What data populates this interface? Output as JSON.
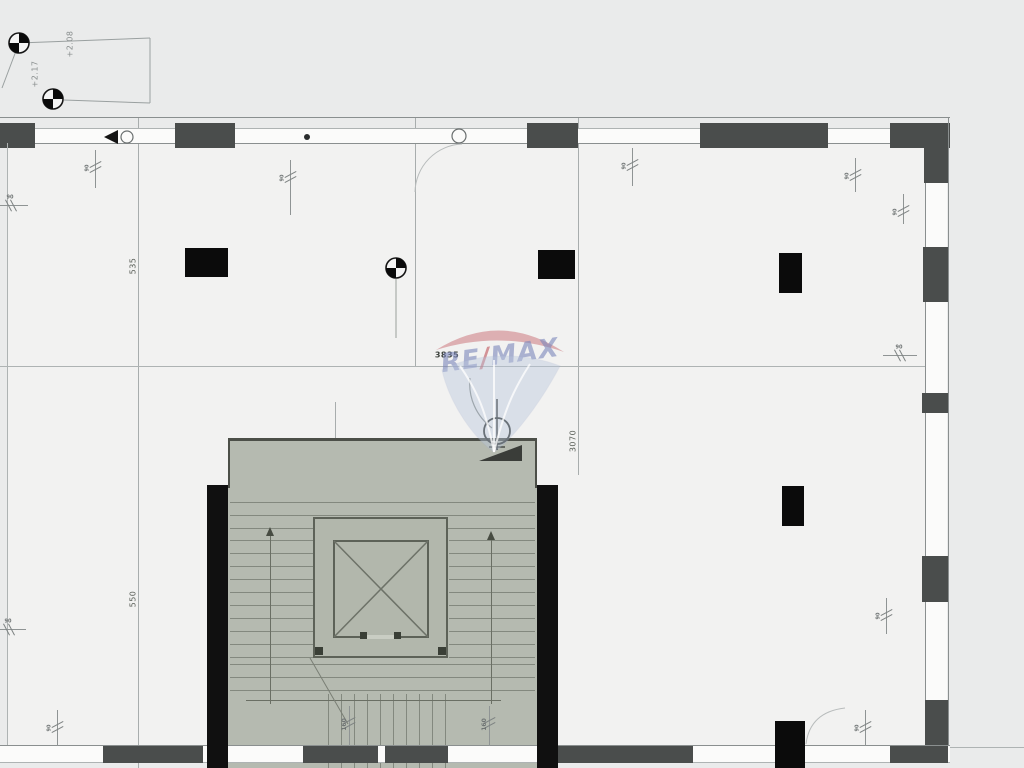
{
  "drawing": {
    "kind": "architectural floor plan",
    "watermark": {
      "re": "RE",
      "slash": "/",
      "max": "MAX"
    },
    "elevations": {
      "marker1": "+2.08",
      "marker2": "+2.17",
      "datum_zero": "±0,00",
      "datum_value": "+2,04"
    },
    "dimensions": {
      "span_width": "3835",
      "span_height": "3070",
      "grid_upper": "535",
      "grid_lower": "550",
      "core_top": "130",
      "stair_left": "7x16x30",
      "stair_right": "7x16x30",
      "stair_bottom": "9X33,6X30"
    },
    "window_marks": [
      {
        "label": "90"
      },
      {
        "label": "90"
      },
      {
        "label": "90"
      },
      {
        "label": "90"
      },
      {
        "label": "90"
      },
      {
        "label": "90"
      },
      {
        "label": "90"
      },
      {
        "label": "90"
      },
      {
        "label": "90"
      },
      {
        "label": "90"
      },
      {
        "label": "90"
      },
      {
        "label": "160"
      },
      {
        "label": "160"
      }
    ],
    "colors": {
      "background": "#eaebeb",
      "floor": "#f2f2f1",
      "wall": "#4a4d4c",
      "column": "#0b0b0b",
      "core_fill": "#b5bab0",
      "remax_red": "#c0545a",
      "remax_blue": "#7b86bb"
    }
  }
}
